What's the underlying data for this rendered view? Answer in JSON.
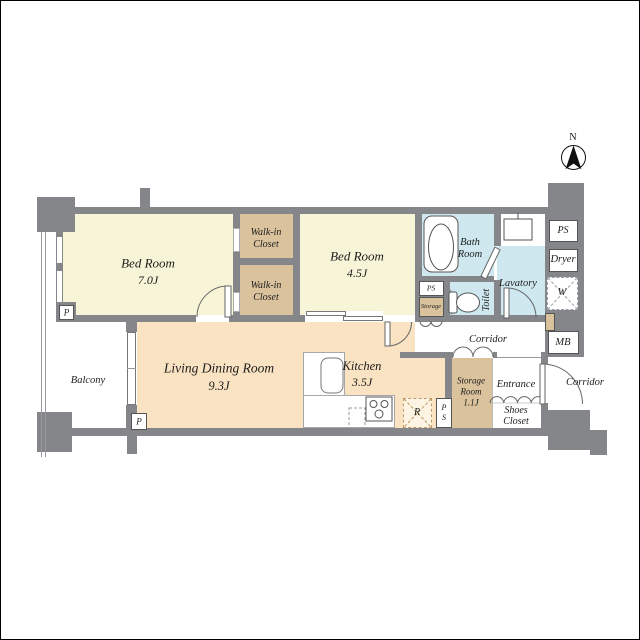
{
  "compass": {
    "north_label": "N"
  },
  "rooms": {
    "bedroom_main": {
      "name": "Bed Room",
      "size": "7.0J"
    },
    "bedroom_second": {
      "name": "Bed Room",
      "size": "4.5J"
    },
    "walkin_closet_upper": {
      "line1": "Walk-in",
      "line2": "Closet"
    },
    "walkin_closet_lower": {
      "line1": "Walk-in",
      "line2": "Closet"
    },
    "bath": {
      "line1": "Bath",
      "line2": "Room"
    },
    "lavatory": {
      "name": "Lavatory"
    },
    "toilet": {
      "name": "Toilet"
    },
    "living_dining": {
      "name": "Living Dining Room",
      "size": "9.3J"
    },
    "kitchen": {
      "name": "Kitchen",
      "size": "3.5J"
    },
    "storage_room": {
      "line1": "Storage",
      "line2": "Room",
      "size": "1.1J"
    },
    "entrance": {
      "name": "Entrance"
    },
    "shoes_closet": {
      "line1": "Shoes",
      "line2": "Closet"
    },
    "balcony": {
      "name": "Balcony"
    },
    "corridor_inner": {
      "name": "Corridor"
    },
    "corridor_outer": {
      "name": "Corridor"
    }
  },
  "labels": {
    "ps_bathside": "PS",
    "storage_small": "Storage",
    "ps_top_right": "PS",
    "dryer": "Dryer",
    "washer": "W",
    "meter_box": "MB",
    "refrigerator": "R",
    "ps_kitchen_p": "P",
    "ps_kitchen_s": "S",
    "pipe_marker_top": "P",
    "pipe_marker_bottom": "P"
  },
  "colors": {
    "wall": "#85868a",
    "room_cream": "#f8f4d8",
    "room_tan": "#d9c29c",
    "room_peach": "#f9e3c2",
    "room_wet_blue": "#cfe8f0",
    "line": "#555555"
  }
}
